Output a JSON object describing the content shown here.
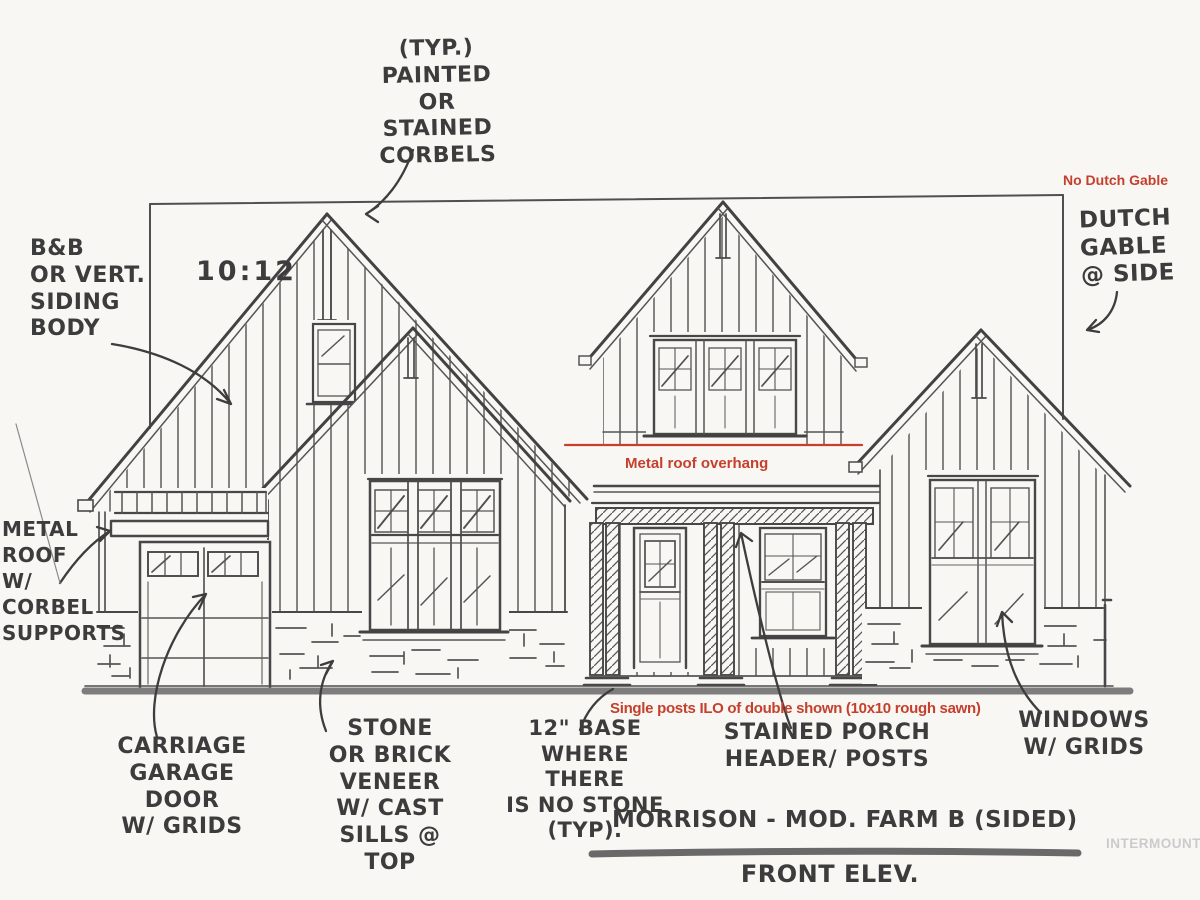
{
  "plan": {
    "slope_ratio": "10:12"
  },
  "annotations": {
    "corbels": "(TYP.)\nPAINTED\nOR STAINED\nCORBELS",
    "siding_body": "B&B\nOR VERT.\nSIDING\nBODY",
    "metal_roof": "METAL\nROOF\nW/\nCORBEL\nSUPPORTS",
    "dutch_gable": "DUTCH\nGABLE\n@ SIDE",
    "carriage_door": "CARRIAGE\nGARAGE\nDOOR\nW/ GRIDS",
    "stone_veneer": "STONE\nOR BRICK\nVENEER\nW/ CAST\nSILLS @\nTOP",
    "stone_base": "12\" BASE\nWHERE THERE\nIS NO STONE\n(TYP).",
    "porch_posts": "STAINED PORCH\nHEADER/ POSTS",
    "windows_grids": "WINDOWS\nW/ GRIDS"
  },
  "redline_notes": {
    "no_dutch_gable": "No Dutch Gable",
    "metal_roof_overhang": "Metal roof overhang",
    "single_posts": "Single posts ILO of double shown (10x10 rough sawn)",
    "color": "#c5402c"
  },
  "titleblock": {
    "title": "MORRISON - MOD. FARM B (SIDED)",
    "subtitle": "FRONT ELEV."
  },
  "watermark": "INTERMOUNTAIN",
  "colors": {
    "ink": "#474747",
    "ground": "#7d7d7d",
    "paper": "#f8f7f4"
  }
}
